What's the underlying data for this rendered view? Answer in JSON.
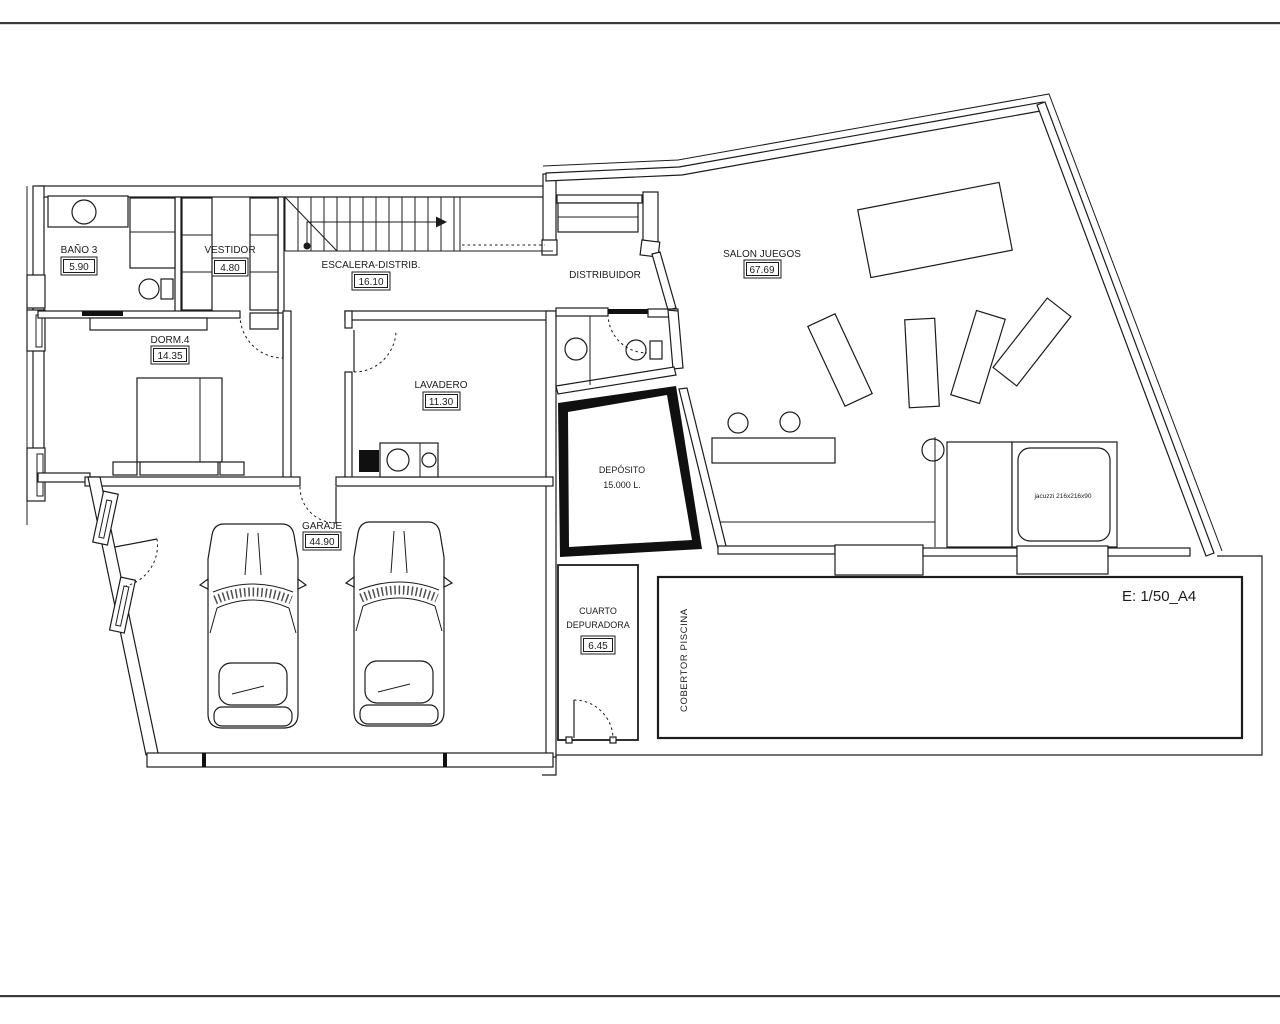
{
  "drawing": {
    "scale_label": "E: 1/50_A4",
    "rooms": {
      "bano3": {
        "name": "BAÑO 3",
        "area": "5.90"
      },
      "vestidor": {
        "name": "VESTIDOR",
        "area": "4.80"
      },
      "escalera": {
        "name": "ESCALERA-DISTRIB.",
        "area": "16.10"
      },
      "dorm4": {
        "name": "DORM.4",
        "area": "14.35"
      },
      "lavadero": {
        "name": "LAVADERO",
        "area": "11.30"
      },
      "distribuidor": {
        "name": "DISTRIBUIDOR"
      },
      "salon_juegos": {
        "name": "SALON JUEGOS",
        "area": "67.69"
      },
      "deposito": {
        "name": "DEPÓSITO",
        "capacity": "15.000 L."
      },
      "garaje": {
        "name": "GARAJE",
        "area": "44.90"
      },
      "cuarto_depuradora": {
        "name_line1": "CUARTO",
        "name_line2": "DEPURADORA",
        "area": "6.45"
      },
      "cobertor_piscina": {
        "name": "COBERTOR PISCINA"
      },
      "jacuzzi": {
        "name": "jacuzzi 216x216x90"
      }
    },
    "colors": {
      "line": "#1c1c1c",
      "deposito_fill": "#101010",
      "background": "#ffffff"
    }
  }
}
